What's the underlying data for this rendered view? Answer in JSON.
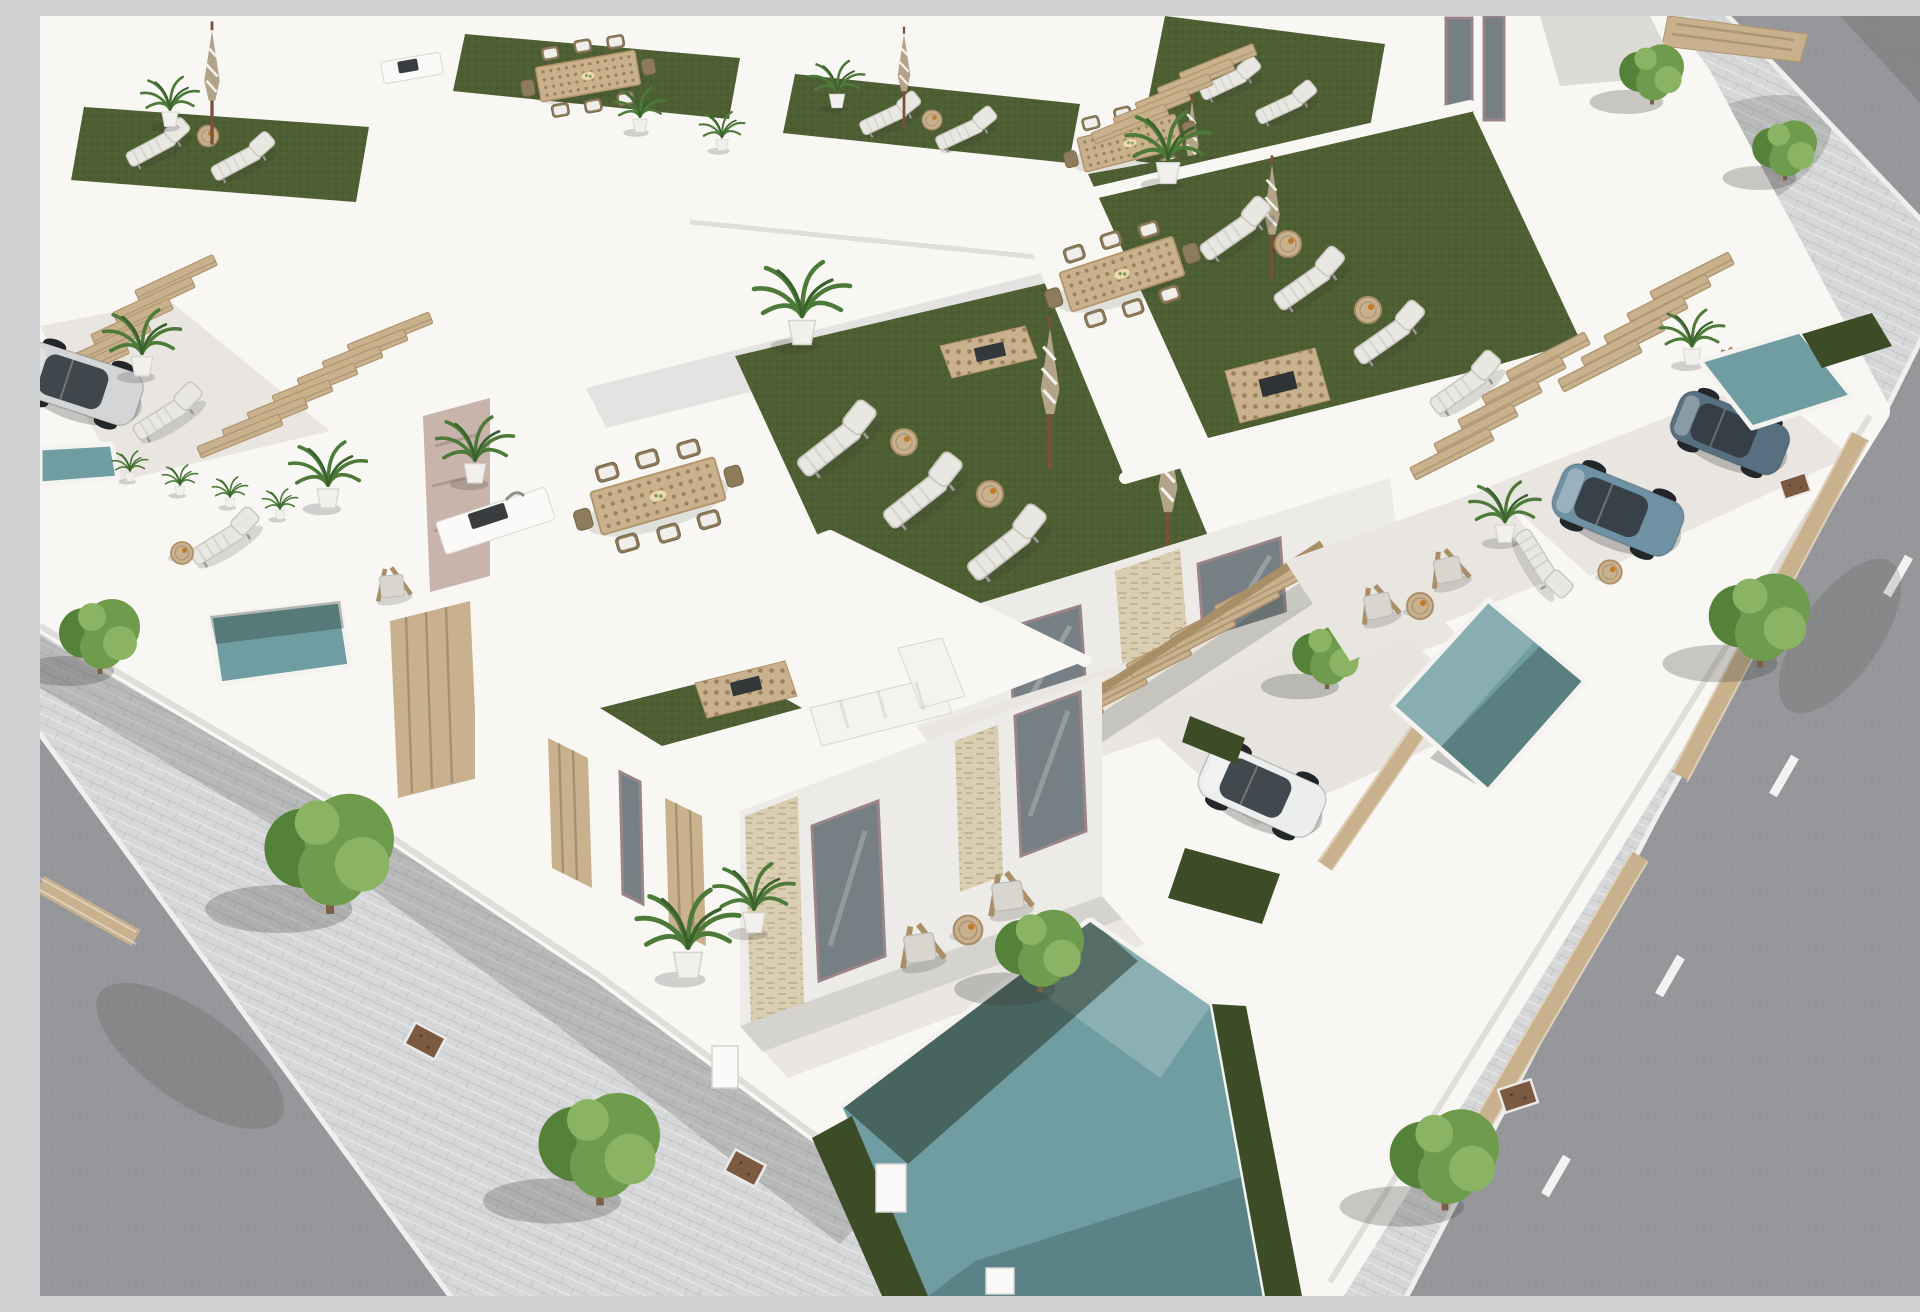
{
  "scene": {
    "title": "Aerial 3D architectural render of a modern white villa development with green rooftop terraces, private plunge pools, parked cars and tree-lined asphalt streets in bright sunlight",
    "setting": "bird's-eye view, midday sun from upper right, long soft shadows to lower left",
    "style": "contemporary Mediterranean new-build complex, white render walls, wood pergola stairs, artificial turf roofs",
    "colors": {
      "sidewalk": "#d6d7d9",
      "road": "#96979a",
      "curb": "#eef0ee",
      "lane": "#f2f3f1",
      "wall_bright": "#f8f7f4",
      "wall_light": "#edebe7",
      "wall_mid": "#dcdad5",
      "wall_shade": "#c7c5c0",
      "turf": "#4e6033",
      "turf_dark": "#3c4c26",
      "pool_mid": "#6f9da1",
      "pool_deep": "#48737c",
      "wood": "#c9b18d",
      "wood_dark": "#a98f68",
      "stone": "#d9cdb2",
      "glass": "#767f83",
      "frame": "#9b8489",
      "cushion": "#e9e7e1",
      "wicker": "#8d7b5c",
      "palm": "#4d7a39",
      "palm_dark": "#3a602e",
      "tree": "#6f9b4c",
      "tree_dark": "#558239",
      "tree_light": "#8ab464",
      "trunk": "#7a5f46",
      "soil": "#7b5a41",
      "car_white": "#eceded",
      "car_silver": "#d3d5d6",
      "car_blue": "#6f91a4",
      "car_dark": "#56707f",
      "umb_tan": "#b2a389",
      "umb_white": "#f3f1ec",
      "shadow": "rgba(60,62,56,0.20)"
    },
    "objects": {
      "villas_label": "white flat-roof villas",
      "rooftop_terraces": 6,
      "pools": 6,
      "cars": 4,
      "car_labels": "two steel-blue SUVs, white hatchback, silver car",
      "street_trees": 9,
      "sun_loungers": 16,
      "closed_parasols": 7,
      "deck_chairs": 6,
      "outdoor_dining_sets": 5,
      "wooden_stair_pergolas": 6,
      "roads": 2,
      "roads_label": "asphalt streets with dashed lane markings"
    }
  }
}
